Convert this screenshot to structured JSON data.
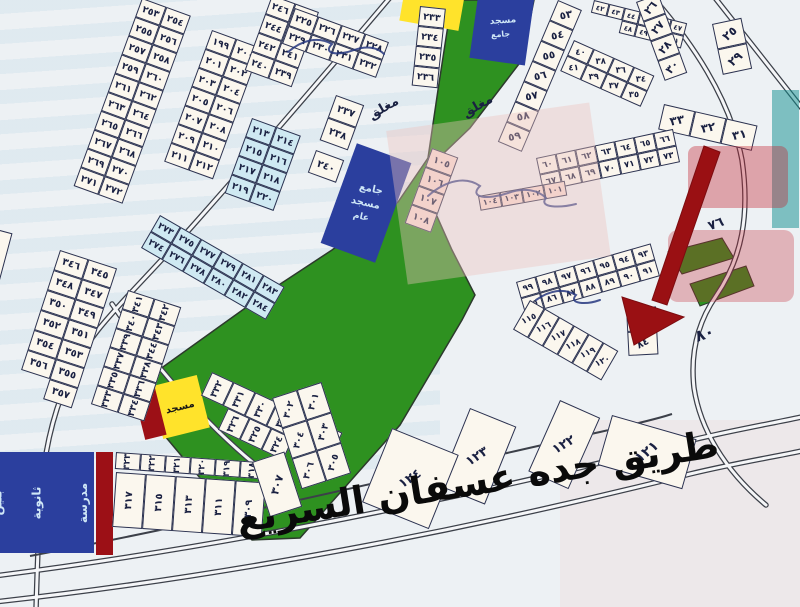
{
  "title": "مخطط أراضي - طريق جده عسفان السريع",
  "colors": {
    "bg": "#edf1f4",
    "cellFill": "#fbf7ee",
    "cellBorder": "#2a3150",
    "num": "#1a2142",
    "lightblue": "#cfe9f2",
    "pink": "#f7ddd4",
    "green": "#2e9120",
    "greenEdge": "#2c3a2c",
    "navy": "#2b3f9e",
    "yellow": "#ffe32b",
    "darkred": "#9c1016",
    "arrow": "#9a1013",
    "road": "#3c4049",
    "roadFill": "#f5f6f8",
    "ink": "#26377f",
    "teal": "#0e8d8d",
    "wmred": "#c22531",
    "wmpink": "#eec4bd",
    "lightText": "#cfe7f7",
    "dark": "#151515"
  },
  "map": {
    "highway_label": "طريق جده عسفان السريع",
    "strips": [
      {
        "name": "plot-strip-253-272",
        "x": 142,
        "y": -2,
        "a": 20,
        "cw": 26,
        "ch": 20,
        "ta": 0,
        "fs": 9.5,
        "rows": [
          [
            "٢٥٣",
            "٢٥٤"
          ],
          [
            "٢٥٥",
            "٢٥٦"
          ],
          [
            "٢٥٧",
            "٢٥٨"
          ],
          [
            "٢٥٩",
            "٢٦٠"
          ],
          [
            "٢٦١",
            "٢٦٢"
          ],
          [
            "٢٦٣",
            "٢٦٤"
          ],
          [
            "٢٦٥",
            "٢٦٦"
          ],
          [
            "٢٦٧",
            "٢٦٨"
          ],
          [
            "٢٦٩",
            "٢٧٠"
          ],
          [
            "٢٧١",
            "٢٧٢"
          ]
        ]
      },
      {
        "name": "plot-strip-199-212",
        "x": 212,
        "y": 30,
        "a": 20,
        "cw": 26,
        "ch": 20,
        "ta": 0,
        "fs": 9.5,
        "rows": [
          [
            "١٩٩",
            "٢٠٠"
          ],
          [
            "٢٠١",
            "٢٠٢"
          ],
          [
            "٢٠٣",
            "٢٠٤"
          ],
          [
            "٢٠٥",
            "٢٠٦"
          ],
          [
            "٢٠٧",
            "٢٠٨"
          ],
          [
            "٢٠٩",
            "٢١٠"
          ],
          [
            "٢١١",
            "٢١٢"
          ]
        ]
      },
      {
        "name": "plot-strip-213-220",
        "x": 252,
        "y": 118,
        "a": 20,
        "cw": 26,
        "ch": 20,
        "ta": 0,
        "fs": 9.5,
        "tint": "lb",
        "rows": [
          [
            "٢١٣",
            "٢١٤"
          ],
          [
            "٢١٥",
            "٢١٦"
          ],
          [
            "٢١٧",
            "٢١٨"
          ],
          [
            "٢١٩",
            "٢٢٠"
          ]
        ]
      },
      {
        "name": "plot-strip-273-284",
        "x": 160,
        "y": 215,
        "a": 30,
        "cw": 24,
        "ch": 19,
        "ta": 0,
        "fs": 9,
        "tint": "lb",
        "rows": [
          [
            "٢٧٣",
            "٢٧٥",
            "٢٧٧",
            "٢٧٩",
            "٢٨١",
            "٢٨٣"
          ],
          [
            "٢٧٤",
            "٢٧٦",
            "٢٧٨",
            "٢٨٠",
            "٢٨٢",
            "٢٨٤"
          ]
        ]
      },
      {
        "name": "plot-strip-304-306",
        "x": -30,
        "y": 222,
        "a": 15,
        "cw": 44,
        "ch": 52,
        "ta": 0,
        "fs": 11,
        "rows": [
          [
            "٣٠٤"
          ],
          [
            "٣٠٦"
          ]
        ]
      },
      {
        "name": "plot-strip-345-357",
        "x": 60,
        "y": 250,
        "a": 18,
        "cw": 30,
        "ch": 21,
        "ta": 0,
        "fs": 10,
        "rows": [
          [
            "٣٤٦",
            "٣٤٥"
          ],
          [
            "٣٤٨",
            "٣٤٧"
          ],
          [
            "٣٥٠",
            "٣٤٩"
          ],
          [
            "٣٥٢",
            "٣٥١"
          ],
          [
            "٣٥٤",
            "٣٥٣"
          ],
          [
            "٣٥٦",
            "٣٥٥"
          ],
          [
            "",
            "٣٥٧"
          ]
        ]
      },
      {
        "name": "plot-strip-333-344",
        "x": 128,
        "y": 290,
        "a": 18,
        "cw": 28,
        "ch": 20,
        "ta": -90,
        "fs": 9.5,
        "rows": [
          [
            "٣٤١",
            "٣٤٢"
          ],
          [
            "٣٤٠",
            "٣٤٣"
          ],
          [
            "٣٣٩",
            "٣٤٤"
          ],
          [
            "٣٣٧",
            "٣٣٨"
          ],
          [
            "٣٣٥",
            "٣٣٦"
          ],
          [
            "٣٣٣",
            "٣٣٤"
          ]
        ]
      },
      {
        "name": "plot-strip-327-332",
        "x": 212,
        "y": 372,
        "a": 25,
        "cw": 24,
        "ch": 26,
        "ta": -90,
        "fs": 9.5,
        "rows": [
          [
            "٣٣٢",
            "٣٣١",
            "٣٣٠",
            "٣٢٩",
            "٣٢٨",
            "٣٢٧"
          ]
        ]
      },
      {
        "name": "plot-strip-324-326",
        "x": 228,
        "y": 408,
        "a": 25,
        "cw": 24,
        "ch": 24,
        "ta": -90,
        "fs": 9.5,
        "rows": [
          [
            "٣٢٦",
            "٣٢٥",
            "٣٢٤"
          ]
        ]
      },
      {
        "name": "plot-strip-318-323",
        "x": 116,
        "y": 452,
        "a": 4,
        "cw": 25,
        "ch": 17,
        "ta": -90,
        "fs": 9,
        "rows": [
          [
            "٣٢٣",
            "٣٢٢",
            "٣٢١",
            "٣٢٠",
            "٣١٩",
            "٣١٨"
          ]
        ]
      },
      {
        "name": "plot-strip-309-317",
        "x": 116,
        "y": 472,
        "a": 4,
        "cw": 30,
        "ch": 55,
        "ta": -90,
        "fs": 10,
        "rows": [
          [
            "٣١٧",
            "٣١٥",
            "٣١٣",
            "٣١١",
            "٣٠٩"
          ]
        ]
      },
      {
        "name": "plot-strip-301-306-fan",
        "x": 272,
        "y": 398,
        "a": -18,
        "cw": 26,
        "ch": 32,
        "ta": -55,
        "fs": 9.5,
        "rows": [
          [
            "٣٠٢",
            "٣٠١"
          ],
          [
            "٣٠٤",
            "٣٠٣"
          ],
          [
            "٣٠٦",
            "٣٠٥"
          ]
        ]
      },
      {
        "name": "plot-307",
        "x": 252,
        "y": 462,
        "a": -18,
        "cw": 34,
        "ch": 58,
        "ta": -55,
        "fs": 11,
        "rows": [
          [
            "٣٠٧"
          ]
        ]
      },
      {
        "name": "plot-strip-239-246",
        "x": 272,
        "y": -5,
        "a": 20,
        "cw": 25,
        "ch": 20,
        "ta": 0,
        "fs": 9.5,
        "rows": [
          [
            "٢٤٦",
            "٢٤٥"
          ],
          [
            "٢٤٤",
            "٢٤٣"
          ],
          [
            "٢٤٢",
            "٢٤١"
          ],
          [
            "٢٤٠",
            "٢٣٩"
          ]
        ]
      },
      {
        "name": "plot-strip-225-232",
        "x": 295,
        "y": 8,
        "a": 20,
        "cw": 25,
        "ch": 19,
        "ta": 0,
        "fs": 9.5,
        "rows": [
          [
            "٢٢٥",
            "٢٢٦",
            "٢٢٧",
            "٢٢٨"
          ],
          [
            "٢٢٩",
            "٢٣٠",
            "٢٣١",
            "٢٣٢"
          ]
        ]
      },
      {
        "name": "plot-strip-233-236",
        "x": 420,
        "y": 6,
        "a": 6,
        "cw": 26,
        "ch": 20,
        "ta": 0,
        "fs": 9.5,
        "rows": [
          [
            "٢٣٣"
          ],
          [
            "٢٣٤"
          ],
          [
            "٢٣٥"
          ],
          [
            "٢٣٦"
          ]
        ]
      },
      {
        "name": "plot-strip-237-238",
        "x": 336,
        "y": 95,
        "a": 20,
        "cw": 30,
        "ch": 24,
        "ta": 0,
        "fs": 10,
        "rows": [
          [
            "٢٣٧"
          ],
          [
            "٢٣٨"
          ]
        ]
      },
      {
        "name": "plot-240",
        "x": 316,
        "y": 150,
        "a": 20,
        "cw": 30,
        "ch": 24,
        "ta": 0,
        "fs": 10,
        "rows": [
          [
            "٢٤٠"
          ]
        ]
      },
      {
        "name": "plot-strip-53-59",
        "x": 558,
        "y": 0,
        "a": 23,
        "cw": 26,
        "ch": 22,
        "ta": -35,
        "fs": 10.5,
        "rows": [
          [
            "٥٣"
          ],
          [
            "٥٤"
          ],
          [
            "٥٥"
          ],
          [
            "٥٦"
          ],
          [
            "٥٧"
          ],
          [
            "٥٨"
          ],
          [
            "٥٩"
          ]
        ]
      },
      {
        "name": "plot-strip-42-51",
        "x": 594,
        "y": 0,
        "a": 14,
        "cw": 16,
        "ch": 13,
        "ta": 0,
        "fs": 7,
        "rows": [
          [
            "٤٢",
            "٤٣",
            "٤٤",
            "٤٥",
            "٤٦",
            "٤٧"
          ],
          [
            "",
            "",
            "٤٨",
            "٤٩",
            "٥٠",
            "٥١"
          ]
        ]
      },
      {
        "name": "plot-strip-34-41",
        "x": 574,
        "y": 40,
        "a": 24,
        "cw": 22,
        "ch": 17,
        "ta": -25,
        "fs": 8.5,
        "rows": [
          [
            "٤٠",
            "٣٨",
            "٣٦",
            "٣٤"
          ],
          [
            "٤١",
            "٣٩",
            "٣٧",
            "٣٥"
          ]
        ]
      },
      {
        "name": "plot-strip-31-33",
        "x": 664,
        "y": 104,
        "a": 13,
        "cw": 32,
        "ch": 26,
        "ta": -25,
        "fs": 12,
        "rows": [
          [
            "٣٣",
            "٣٢",
            "٣١"
          ]
        ]
      },
      {
        "name": "plot-strip-26-30",
        "x": 636,
        "y": 2,
        "a": -20,
        "cw": 24,
        "ch": 21,
        "ta": -30,
        "fs": 11,
        "rows": [
          [
            "٢٦"
          ],
          [
            "٢٧"
          ],
          [
            "٢٨"
          ],
          [
            "٣٠"
          ]
        ]
      },
      {
        "name": "plot-strip-25-29",
        "x": 712,
        "y": 24,
        "a": -12,
        "cw": 30,
        "ch": 26,
        "ta": -30,
        "fs": 12,
        "rows": [
          [
            "٢٥"
          ],
          [
            "٢٩"
          ]
        ]
      },
      {
        "name": "plot-strip-60-73",
        "x": 536,
        "y": 158,
        "a": -12,
        "cw": 20,
        "ch": 17,
        "ta": 0,
        "fs": 8.5,
        "rows": [
          [
            "٦٠",
            "٦١",
            "٦٢",
            "٦٣",
            "٦٤",
            "٦٥",
            "٦٦"
          ],
          [
            "٦٧",
            "٦٨",
            "٦٩",
            "٧٠",
            "٧١",
            "٧٢",
            "٧٣"
          ]
        ]
      },
      {
        "name": "plot-strip-85-99",
        "x": 516,
        "y": 282,
        "a": -16,
        "cw": 20,
        "ch": 17,
        "ta": 0,
        "fs": 8.5,
        "rows": [
          [
            "٩٩",
            "٩٨",
            "٩٧",
            "٩٦",
            "٩٥",
            "٩٤",
            "٩٣"
          ],
          [
            "٨٥",
            "٨٦",
            "٨٧",
            "٨٨",
            "٨٩",
            "٩٠",
            "٩١"
          ]
        ]
      },
      {
        "name": "plot-strip-101-104",
        "x": 478,
        "y": 196,
        "a": -10,
        "cw": 22,
        "ch": 15,
        "ta": 0,
        "fs": 8,
        "tint": "pk",
        "rows": [
          [
            "١٠٤",
            "١٠٣",
            "١٠٢",
            "١٠١"
          ]
        ]
      },
      {
        "name": "plot-strip-105-108",
        "x": 432,
        "y": 148,
        "a": 20,
        "cw": 28,
        "ch": 20,
        "ta": 0,
        "fs": 9.5,
        "tint": "pk",
        "rows": [
          [
            "١٠٥"
          ],
          [
            "١٠٦"
          ],
          [
            "١٠٧"
          ],
          [
            "١٠٨"
          ]
        ]
      },
      {
        "name": "plot-strip-115-120",
        "x": 530,
        "y": 300,
        "a": 30,
        "cw": 17,
        "ch": 34,
        "ta": -55,
        "fs": 8.5,
        "rows": [
          [
            "١١٥",
            "١١٦",
            "١١٧",
            "١١٨",
            "١١٩",
            "١٢٠"
          ]
        ]
      },
      {
        "name": "plot-strip-83-84",
        "x": 626,
        "y": 308,
        "a": -3,
        "cw": 30,
        "ch": 24,
        "ta": -25,
        "fs": 10,
        "rows": [
          [
            "٨٣"
          ],
          [
            "٨٤"
          ]
        ]
      },
      {
        "name": "plot-121",
        "x": 612,
        "y": 415,
        "a": 16,
        "cw": 88,
        "ch": 52,
        "ta": -55,
        "fs": 14,
        "rows": [
          [
            "١٢١"
          ]
        ]
      },
      {
        "name": "plot-122",
        "x": 560,
        "y": 400,
        "a": 24,
        "cw": 44,
        "ch": 78,
        "ta": -55,
        "fs": 13,
        "rows": [
          [
            "١٢٢"
          ]
        ]
      },
      {
        "name": "plot-123",
        "x": 470,
        "y": 408,
        "a": 22,
        "cw": 50,
        "ch": 84,
        "ta": -55,
        "fs": 13,
        "rows": [
          [
            "١٢٣"
          ]
        ]
      },
      {
        "name": "plot-124",
        "x": 392,
        "y": 428,
        "a": 22,
        "cw": 72,
        "ch": 80,
        "ta": -55,
        "fs": 13,
        "rows": [
          [
            "١٢٤"
          ]
        ]
      }
    ],
    "labels": [
      {
        "name": "closed-street-label",
        "text": "مغلق",
        "x": 366,
        "y": 110,
        "a": -30,
        "fs": 13
      },
      {
        "name": "closed-street-label",
        "text": "مغلق",
        "x": 460,
        "y": 108,
        "a": -30,
        "fs": 13
      },
      {
        "name": "plot-80-label",
        "text": "٨٠",
        "x": 692,
        "y": 328,
        "a": -20,
        "fs": 16
      },
      {
        "name": "plot-76-label",
        "text": "٧٦",
        "x": 706,
        "y": 220,
        "a": -20,
        "fs": 13
      }
    ],
    "blocks": [
      {
        "name": "mosque-block-top",
        "x": 474,
        "y": -8,
        "w": 56,
        "h": 70,
        "a": 8,
        "color": "navy",
        "texts": [
          {
            "text": "مسجد",
            "fs": 9,
            "color": "lightText",
            "a": -12
          },
          {
            "text": "جامع",
            "fs": 8,
            "color": "lightText",
            "a": -12
          }
        ]
      },
      {
        "name": "mosque-block-park",
        "x": 337,
        "y": 150,
        "w": 58,
        "h": 106,
        "a": 20,
        "color": "navy",
        "texts": [
          {
            "text": "جامع",
            "fs": 10,
            "color": "lightText",
            "a": -8
          },
          {
            "text": "مسجد",
            "fs": 10,
            "color": "lightText",
            "a": -8
          },
          {
            "text": "عام",
            "fs": 9,
            "color": "lightText",
            "a": -8
          }
        ]
      },
      {
        "name": "school-block",
        "x": -6,
        "y": 452,
        "w": 100,
        "h": 101,
        "a": 0,
        "color": "navy",
        "cls": "tex",
        "tcls": "trow",
        "texts": [
          {
            "text": "مدرسة",
            "fs": 12,
            "color": "lightText",
            "a": -90
          },
          {
            "text": "ثانوية",
            "fs": 12,
            "color": "lightText",
            "a": -90
          },
          {
            "text": "بنين",
            "fs": 12,
            "color": "lightText",
            "a": -90
          }
        ]
      },
      {
        "name": "yellow-plot-top",
        "x": 402,
        "y": -10,
        "w": 60,
        "h": 36,
        "a": 10,
        "color": "yellow"
      },
      {
        "name": "mosque-block-yellow",
        "x": 156,
        "y": 380,
        "w": 48,
        "h": 54,
        "a": -14,
        "color": "yellow",
        "texts": [
          {
            "text": "مسجد",
            "fs": 10,
            "color": "dark",
            "a": 0
          }
        ]
      },
      {
        "name": "red-strip-block",
        "x": 96,
        "y": 452,
        "w": 17,
        "h": 103,
        "a": 0,
        "color": "darkred"
      },
      {
        "name": "red-small-block",
        "x": 139,
        "y": 389,
        "w": 22,
        "h": 49,
        "a": -14,
        "color": "darkred"
      },
      {
        "name": "watermark-teal-mark",
        "x": 772,
        "y": 90,
        "w": 27,
        "h": 138,
        "a": 0,
        "color": "teal",
        "op": 0.5,
        "z": 5
      },
      {
        "name": "watermark-red-mark",
        "x": 688,
        "y": 146,
        "w": 100,
        "h": 62,
        "a": 0,
        "color": "wmred",
        "op": 0.38,
        "z": 5,
        "r": 8
      },
      {
        "name": "watermark-red-mark",
        "x": 668,
        "y": 230,
        "w": 126,
        "h": 72,
        "a": 0,
        "color": "wmred",
        "op": 0.3,
        "z": 5,
        "r": 10
      },
      {
        "name": "watermark-pink-band",
        "x": 396,
        "y": 116,
        "w": 205,
        "h": 155,
        "a": -8,
        "color": "wmpink",
        "op": 0.4,
        "z": 5
      },
      {
        "name": "watermark-pink-corner",
        "x": 560,
        "y": 420,
        "w": 240,
        "h": 187,
        "a": 0,
        "color": "wmpink",
        "op": 0.18,
        "z": 0
      }
    ]
  }
}
